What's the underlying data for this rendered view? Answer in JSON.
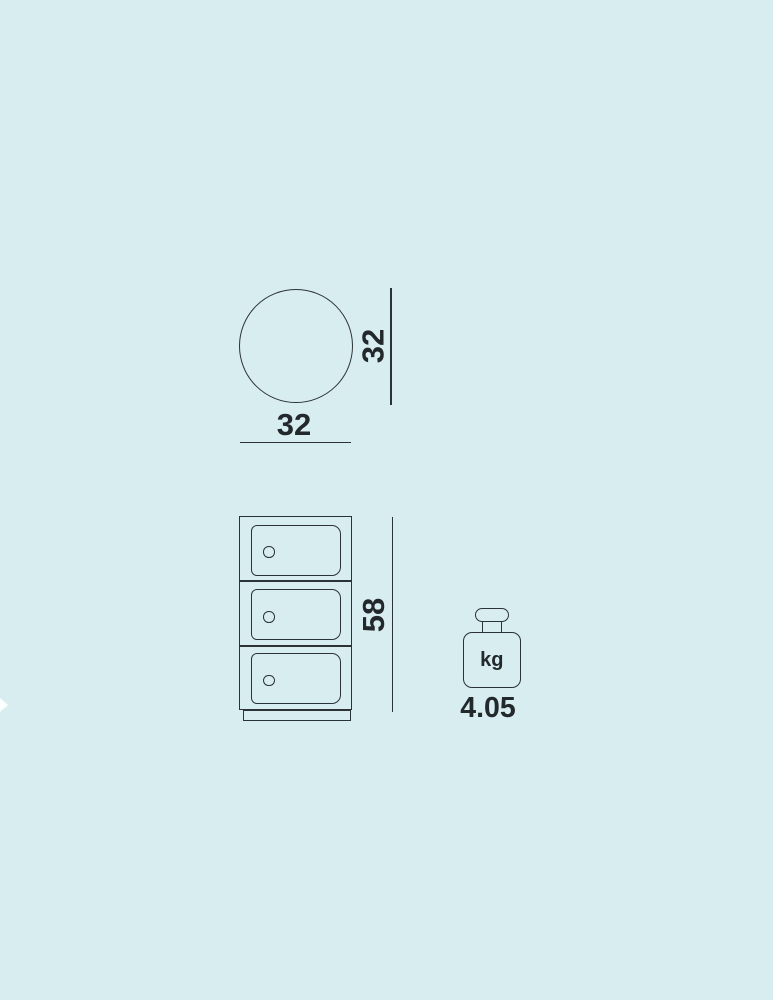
{
  "colors": {
    "background": "#d7edef",
    "line": "#2c3336",
    "text": "#22282b"
  },
  "diagram": {
    "top_view": {
      "width_label": "32",
      "depth_label": "32"
    },
    "front_view": {
      "height_label": "58",
      "drawer_count": 3
    },
    "weight": {
      "unit_label": "kg",
      "value_label": "4.05"
    }
  }
}
